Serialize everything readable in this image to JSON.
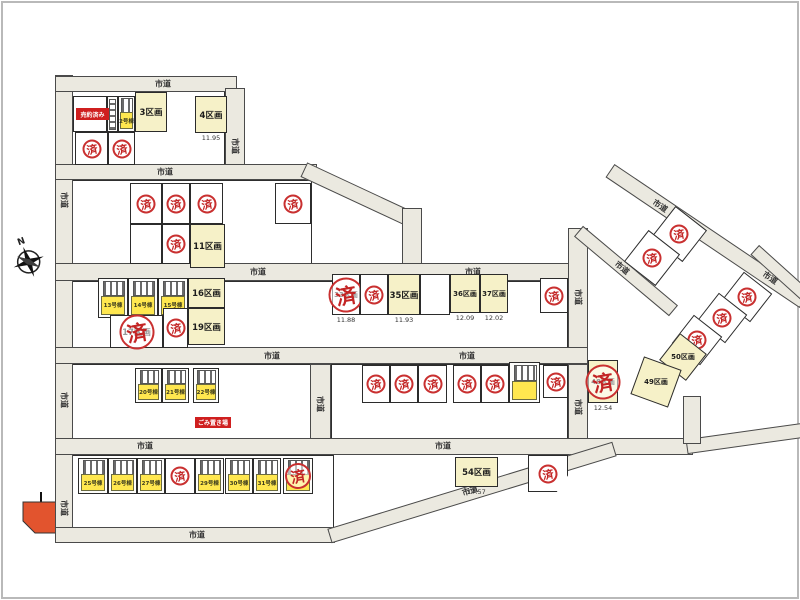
{
  "map": {
    "road_label_text": "市道",
    "stamp_char": "済",
    "compass_n": "N",
    "colors": {
      "road": "#ebe9e0",
      "lot_available": "#f6f1c8",
      "house_yellow": "#ffe74f",
      "stamp_red": "#c32525",
      "note_red": "#cf1f1f",
      "pond_orange": "#e2542e"
    },
    "notes": [
      {
        "text": "売約済み",
        "x": 76,
        "y": 108,
        "w": 33,
        "h": 12
      },
      {
        "text": "ごみ置き場",
        "x": 195,
        "y": 417,
        "w": 36,
        "h": 11
      }
    ],
    "blocks": [
      {
        "x": 72,
        "y": 90,
        "w": 153,
        "h": 76
      },
      {
        "x": 72,
        "y": 180,
        "w": 240,
        "h": 85
      },
      {
        "x": 72,
        "y": 281,
        "w": 496,
        "h": 67
      },
      {
        "x": 72,
        "y": 364,
        "w": 239,
        "h": 75
      },
      {
        "x": 331,
        "y": 364,
        "w": 237,
        "h": 75
      },
      {
        "x": 72,
        "y": 455,
        "w": 262,
        "h": 73
      }
    ],
    "roads": [
      {
        "x": 55,
        "y": 75,
        "w": 18,
        "h": 457
      },
      {
        "x": 55,
        "y": 76,
        "w": 182,
        "h": 16
      },
      {
        "x": 225,
        "y": 88,
        "w": 20,
        "h": 80
      },
      {
        "x": 55,
        "y": 164,
        "w": 262,
        "h": 16
      },
      {
        "cx": 360,
        "cy": 196,
        "len": 125,
        "th": 16,
        "a": 25
      },
      {
        "x": 402,
        "y": 208,
        "w": 20,
        "h": 62
      },
      {
        "x": 55,
        "y": 263,
        "w": 533,
        "h": 18
      },
      {
        "x": 568,
        "y": 228,
        "w": 20,
        "h": 126
      },
      {
        "x": 55,
        "y": 347,
        "w": 533,
        "h": 17
      },
      {
        "x": 310,
        "y": 364,
        "w": 21,
        "h": 80
      },
      {
        "x": 568,
        "y": 364,
        "w": 20,
        "h": 82
      },
      {
        "x": 55,
        "y": 438,
        "w": 638,
        "h": 17
      },
      {
        "cx": 745,
        "cy": 438,
        "len": 118,
        "th": 15,
        "a": -8
      },
      {
        "x": 55,
        "y": 527,
        "w": 280,
        "h": 16
      },
      {
        "cx": 472,
        "cy": 492,
        "len": 298,
        "th": 15,
        "a": -17
      },
      {
        "cx": 707,
        "cy": 236,
        "len": 234,
        "th": 16,
        "a": 34
      },
      {
        "cx": 626,
        "cy": 271,
        "len": 124,
        "th": 14,
        "a": 40
      },
      {
        "cx": 780,
        "cy": 272,
        "len": 68,
        "th": 13,
        "a": 42
      },
      {
        "x": 683,
        "y": 396,
        "w": 18,
        "h": 48
      }
    ],
    "road_labels": [
      {
        "text": "市道",
        "x": 163,
        "y": 84,
        "r": 0
      },
      {
        "text": "市道",
        "x": 235,
        "y": 146,
        "r": 90
      },
      {
        "text": "市道",
        "x": 64,
        "y": 200,
        "r": 90
      },
      {
        "text": "市道",
        "x": 64,
        "y": 400,
        "r": 90
      },
      {
        "text": "市道",
        "x": 64,
        "y": 508,
        "r": 90
      },
      {
        "text": "市道",
        "x": 165,
        "y": 172,
        "r": 0
      },
      {
        "text": "市道",
        "x": 258,
        "y": 272,
        "r": 0
      },
      {
        "text": "市道",
        "x": 473,
        "y": 272,
        "r": 0
      },
      {
        "text": "市道",
        "x": 578,
        "y": 297,
        "r": 90
      },
      {
        "text": "市道",
        "x": 272,
        "y": 356,
        "r": 0
      },
      {
        "text": "市道",
        "x": 467,
        "y": 356,
        "r": 0
      },
      {
        "text": "市道",
        "x": 320,
        "y": 404,
        "r": 90
      },
      {
        "text": "市道",
        "x": 578,
        "y": 407,
        "r": 90
      },
      {
        "text": "市道",
        "x": 145,
        "y": 446,
        "r": 0
      },
      {
        "text": "市道",
        "x": 443,
        "y": 446,
        "r": 0
      },
      {
        "text": "市道",
        "x": 197,
        "y": 535,
        "r": 0
      },
      {
        "text": "市道",
        "x": 470,
        "y": 491,
        "r": -17
      },
      {
        "text": "市道",
        "x": 660,
        "y": 206,
        "r": 34
      },
      {
        "text": "市道",
        "x": 770,
        "y": 278,
        "r": 34
      },
      {
        "text": "市道",
        "x": 622,
        "y": 268,
        "r": 40
      }
    ],
    "lots": [
      {
        "x": 73,
        "y": 96,
        "w": 34,
        "h": 36,
        "f": "w"
      },
      {
        "x": 107,
        "y": 96,
        "w": 11,
        "h": 36,
        "f": "p"
      },
      {
        "x": 118,
        "y": 96,
        "w": 17,
        "h": 36,
        "f": "h",
        "label": "2号棟"
      },
      {
        "x": 135,
        "y": 92,
        "w": 32,
        "h": 40,
        "f": "a",
        "label": "3区画"
      },
      {
        "x": 195,
        "y": 96,
        "w": 32,
        "h": 37,
        "f": "a",
        "label": "4区画",
        "num": "11.95"
      },
      {
        "x": 75,
        "y": 132,
        "w": 33,
        "h": 33,
        "f": "w",
        "st": "s"
      },
      {
        "x": 108,
        "y": 132,
        "w": 27,
        "h": 33,
        "f": "w",
        "st": "s"
      },
      {
        "x": 130,
        "y": 183,
        "w": 32,
        "h": 41,
        "f": "w",
        "st": "s"
      },
      {
        "x": 162,
        "y": 183,
        "w": 28,
        "h": 41,
        "f": "w",
        "st": "s"
      },
      {
        "x": 190,
        "y": 183,
        "w": 33,
        "h": 41,
        "f": "w",
        "st": "s"
      },
      {
        "x": 275,
        "y": 183,
        "w": 36,
        "h": 41,
        "f": "w",
        "st": "s"
      },
      {
        "x": 130,
        "y": 224,
        "w": 32,
        "h": 40,
        "f": "w"
      },
      {
        "x": 162,
        "y": 224,
        "w": 28,
        "h": 40,
        "f": "w",
        "st": "s"
      },
      {
        "x": 190,
        "y": 224,
        "w": 35,
        "h": 44,
        "f": "a",
        "label": "11区画"
      },
      {
        "x": 98,
        "y": 278,
        "w": 30,
        "h": 40,
        "f": "h",
        "label": "13号棟"
      },
      {
        "x": 128,
        "y": 278,
        "w": 30,
        "h": 40,
        "f": "h",
        "label": "14号棟"
      },
      {
        "x": 158,
        "y": 278,
        "w": 30,
        "h": 40,
        "f": "h",
        "label": "15号棟"
      },
      {
        "x": 188,
        "y": 278,
        "w": 37,
        "h": 30,
        "f": "a",
        "label": "16区画"
      },
      {
        "x": 110,
        "y": 315,
        "w": 53,
        "h": 33,
        "f": "w",
        "st": "b",
        "label": "17区画"
      },
      {
        "x": 163,
        "y": 308,
        "w": 25,
        "h": 40,
        "f": "w",
        "st": "s"
      },
      {
        "x": 188,
        "y": 308,
        "w": 37,
        "h": 37,
        "f": "a",
        "label": "19区画"
      },
      {
        "x": 135,
        "y": 368,
        "w": 27,
        "h": 35,
        "f": "h",
        "label": "20号棟"
      },
      {
        "x": 162,
        "y": 368,
        "w": 27,
        "h": 35,
        "f": "h",
        "label": "21号棟"
      },
      {
        "x": 193,
        "y": 368,
        "w": 26,
        "h": 35,
        "f": "h",
        "label": "22号棟"
      },
      {
        "x": 332,
        "y": 274,
        "w": 28,
        "h": 41,
        "f": "w",
        "st": "b",
        "label": "33区画",
        "num": "11.88"
      },
      {
        "x": 360,
        "y": 274,
        "w": 28,
        "h": 41,
        "f": "w",
        "st": "s"
      },
      {
        "x": 388,
        "y": 274,
        "w": 32,
        "h": 41,
        "f": "a",
        "label": "35区画",
        "num": "11.93"
      },
      {
        "x": 420,
        "y": 274,
        "w": 30,
        "h": 41,
        "f": "w"
      },
      {
        "x": 450,
        "y": 274,
        "w": 30,
        "h": 39,
        "f": "a",
        "label": "36区画",
        "num": "12.09"
      },
      {
        "x": 480,
        "y": 274,
        "w": 28,
        "h": 39,
        "f": "a",
        "label": "37区画",
        "num": "12.02"
      },
      {
        "x": 540,
        "y": 278,
        "w": 28,
        "h": 35,
        "f": "w",
        "st": "s"
      },
      {
        "x": 362,
        "y": 365,
        "w": 28,
        "h": 38,
        "f": "w",
        "st": "s"
      },
      {
        "x": 390,
        "y": 365,
        "w": 28,
        "h": 38,
        "f": "w",
        "st": "s"
      },
      {
        "x": 418,
        "y": 365,
        "w": 29,
        "h": 38,
        "f": "w",
        "st": "s"
      },
      {
        "x": 453,
        "y": 365,
        "w": 28,
        "h": 38,
        "f": "w",
        "st": "s"
      },
      {
        "x": 481,
        "y": 365,
        "w": 28,
        "h": 38,
        "f": "w",
        "st": "s"
      },
      {
        "x": 509,
        "y": 362,
        "w": 31,
        "h": 41,
        "f": "h"
      },
      {
        "x": 543,
        "y": 365,
        "w": 25,
        "h": 33,
        "f": "w",
        "st": "s"
      },
      {
        "x": 588,
        "y": 360,
        "w": 30,
        "h": 43,
        "f": "a",
        "st": "b",
        "label": "48区画",
        "num": "12.54"
      },
      {
        "x": 78,
        "y": 458,
        "w": 30,
        "h": 36,
        "f": "h",
        "label": "25号棟"
      },
      {
        "x": 108,
        "y": 458,
        "w": 29,
        "h": 36,
        "f": "h",
        "label": "26号棟"
      },
      {
        "x": 137,
        "y": 458,
        "w": 28,
        "h": 36,
        "f": "h",
        "label": "27号棟"
      },
      {
        "x": 165,
        "y": 458,
        "w": 30,
        "h": 36,
        "f": "w",
        "st": "s"
      },
      {
        "x": 195,
        "y": 458,
        "w": 29,
        "h": 36,
        "f": "h",
        "label": "29号棟"
      },
      {
        "x": 225,
        "y": 458,
        "w": 28,
        "h": 36,
        "f": "h",
        "label": "30号棟"
      },
      {
        "x": 253,
        "y": 458,
        "w": 28,
        "h": 36,
        "f": "h",
        "label": "31号棟"
      },
      {
        "x": 283,
        "y": 458,
        "w": 30,
        "h": 36,
        "f": "h",
        "st": "m"
      },
      {
        "x": 455,
        "y": 457,
        "w": 43,
        "h": 30,
        "f": "a",
        "label": "54区画",
        "num": "17.57"
      },
      {
        "x": 528,
        "y": 455,
        "w": 40,
        "h": 37,
        "f": "w",
        "st": "s",
        "clip": "polygon(0 0,100% 0,100% 55%,72% 100%,0 100%)"
      }
    ],
    "diamonds": [
      {
        "cx": 679,
        "cy": 234,
        "s": 40,
        "a": 38,
        "f": "w",
        "st": "s"
      },
      {
        "cx": 652,
        "cy": 258,
        "s": 40,
        "a": 38,
        "f": "w",
        "st": "s"
      },
      {
        "cx": 747,
        "cy": 297,
        "s": 36,
        "a": 38,
        "f": "w",
        "st": "s"
      },
      {
        "cx": 722,
        "cy": 318,
        "s": 36,
        "a": 38,
        "f": "w",
        "st": "s"
      },
      {
        "cx": 697,
        "cy": 340,
        "s": 36,
        "a": 38,
        "f": "w",
        "st": "s"
      },
      {
        "cx": 683,
        "cy": 357,
        "s": 34,
        "a": 38,
        "f": "a",
        "label": "50区画"
      },
      {
        "cx": 656,
        "cy": 382,
        "s": 40,
        "a": 20,
        "f": "a",
        "label": "49区画"
      }
    ]
  }
}
